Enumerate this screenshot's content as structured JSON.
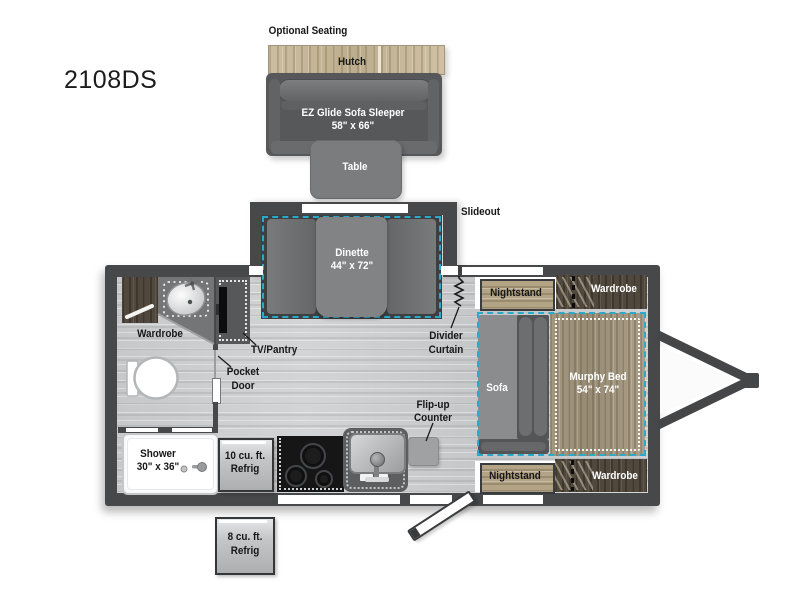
{
  "model_label": "2108DS",
  "optional_seating": {
    "title": "Optional Seating",
    "hutch": "Hutch",
    "sofa_line1": "EZ Glide Sofa Sleeper",
    "sofa_line2": "58\" x 66\"",
    "table": "Table"
  },
  "slideout": {
    "label": "Slideout",
    "dinette_line1": "Dinette",
    "dinette_line2": "44\" x 72\"",
    "divider_line1": "Divider",
    "divider_line2": "Curtain"
  },
  "bedroom": {
    "nightstand_top": "Nightstand",
    "wardrobe_top": "Wardrobe",
    "sofa": "Sofa",
    "murphy_line1": "Murphy Bed",
    "murphy_line2": "54\" x 74\"",
    "nightstand_bottom": "Nightstand",
    "wardrobe_bottom": "Wardrobe"
  },
  "bathroom": {
    "wardrobe": "Wardrobe",
    "pocket_line1": "Pocket",
    "pocket_line2": "Door",
    "shower_line1": "Shower",
    "shower_line2": "30\" x 36\""
  },
  "kitchen": {
    "tv_pantry": "TV/Pantry",
    "fridge10_line1": "10 cu. ft.",
    "fridge10_line2": "Refrig",
    "flipup_line1": "Flip-up",
    "flipup_line2": "Counter",
    "fridge8_line1": "8 cu. ft.",
    "fridge8_line2": "Refrig"
  },
  "colors": {
    "wall": "#47484a",
    "accent_teal": "#2ba9c9",
    "wood_light": "#c6b796",
    "wood_mid": "#a1957d",
    "wood_dark": "#51483d",
    "furniture_gray": "#6e6f71",
    "floor": "#cbccce"
  }
}
